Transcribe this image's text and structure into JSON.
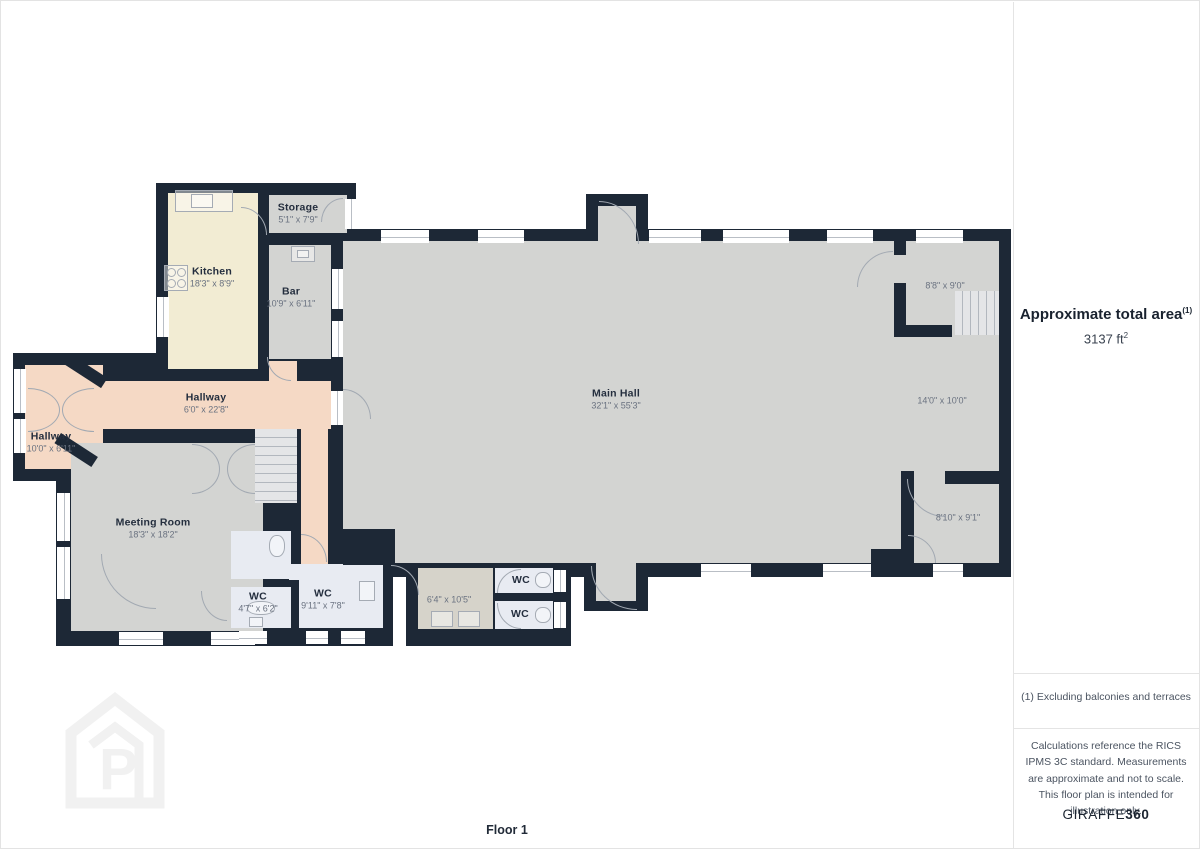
{
  "floor_label": "Floor 1",
  "sidebar": {
    "title": "Approximate total area",
    "title_superscript": "(1)",
    "total_area_value": "3137 ft",
    "total_area_superscript": "2",
    "note1": "(1) Excluding balconies and terraces",
    "note2": "Calculations reference the RICS IPMS 3C standard. Measurements are approximate and not to scale. This floor plan is intended for illustration only.",
    "brand_regular": "GIRAFFE",
    "brand_bold": "360"
  },
  "rooms": {
    "kitchen": {
      "name": "Kitchen",
      "dims": "18'3\" x 8'9\""
    },
    "storage": {
      "name": "Storage",
      "dims": "5'1\" x 7'9\""
    },
    "bar": {
      "name": "Bar",
      "dims": "10'9\" x 6'11\""
    },
    "main_hall": {
      "name": "Main Hall",
      "dims": "32'1\" x 55'3\""
    },
    "hallway_main": {
      "name": "Hallway",
      "dims": "6'0\" x 22'8\""
    },
    "hallway_left": {
      "name": "Hallway",
      "dims": "10'0\" x 6'11\""
    },
    "meeting_room": {
      "name": "Meeting Room",
      "dims": "18'3\" x 18'2\""
    },
    "wc_small": {
      "name": "WC",
      "dims": "4'7\" x 6'2\""
    },
    "wc_large": {
      "name": "WC",
      "dims": "9'11\" x 7'8\""
    },
    "lobby": {
      "dims": "6'4\" x 10'5\""
    },
    "wc_north": {
      "name": "WC"
    },
    "wc_south": {
      "name": "WC"
    },
    "room_top_right": {
      "dims": "8'8\" x 9'0\""
    },
    "room_mid_right": {
      "dims": "14'0\" x 10'0\""
    },
    "room_bottom_right": {
      "dims": "8'10\" x 9'1\""
    }
  },
  "colors": {
    "wall": "#1d2836",
    "floor_gray": "#d3d4d2",
    "kitchen": "#f2ecd3",
    "hallway": "#f5d9c5",
    "wc": "#e8ebf2",
    "lobby": "#d6d3ca",
    "stairs": "#e4e5e7"
  }
}
